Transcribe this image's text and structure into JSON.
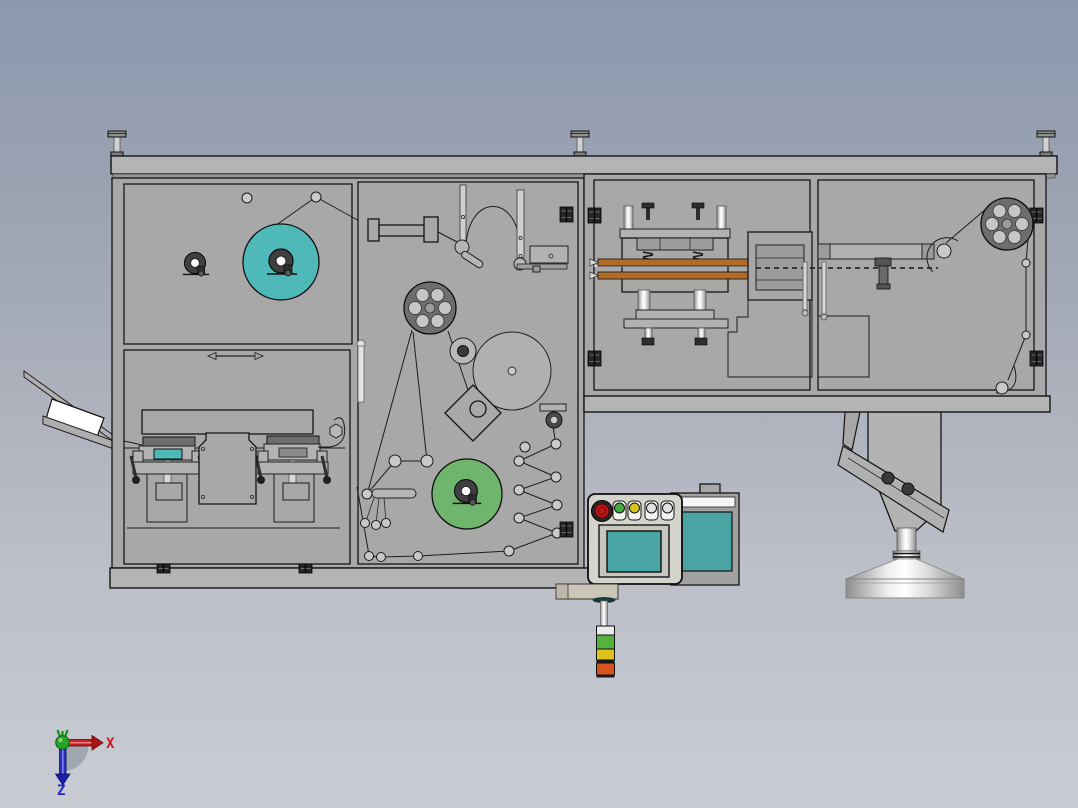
{
  "scene": {
    "type": "cad-3d-view",
    "description": "Blister packaging machine 3D CAD model, front elevation view",
    "background_top": "#8c98ae",
    "background_bottom": "#c9ccd3"
  },
  "triad": {
    "x_label": "X",
    "z_label": "Z",
    "x_color": "#cf1515",
    "z_color": "#1f25c8",
    "y_color": "#1ea51e",
    "shadow_color": "#99a1ac"
  },
  "machine": {
    "frame_color": "#b4b4b4",
    "panel_color": "#a8a8a8",
    "outline_color": "#161616",
    "film_reel_color": "#4fb9b9",
    "lid_reel_color": "#70b56d",
    "index_wheel_color": "#6e6e6e",
    "heater_bar_color": "#b26c28",
    "station_insert_color": "#4fb9b9",
    "chute_plate_color": "#ffffff"
  },
  "control_panel": {
    "body_color": "#d4d3cc",
    "screen_color": "#4aa4a4",
    "back_screen_color": "#4aa4a4",
    "buttons": [
      {
        "name": "emergency-stop",
        "color": "#c41414"
      },
      {
        "name": "button-green",
        "color": "#3fae3f"
      },
      {
        "name": "button-yellow",
        "color": "#d8c41c"
      },
      {
        "name": "button-white-1",
        "color": "#e2e2de"
      },
      {
        "name": "button-white-2",
        "color": "#e2e2de"
      }
    ]
  },
  "tower_light": {
    "segments": [
      {
        "name": "cap",
        "color": "#ececec"
      },
      {
        "name": "green",
        "color": "#55b23c"
      },
      {
        "name": "yellow",
        "color": "#e0c01e"
      },
      {
        "name": "red",
        "color": "#d9541d"
      }
    ]
  }
}
